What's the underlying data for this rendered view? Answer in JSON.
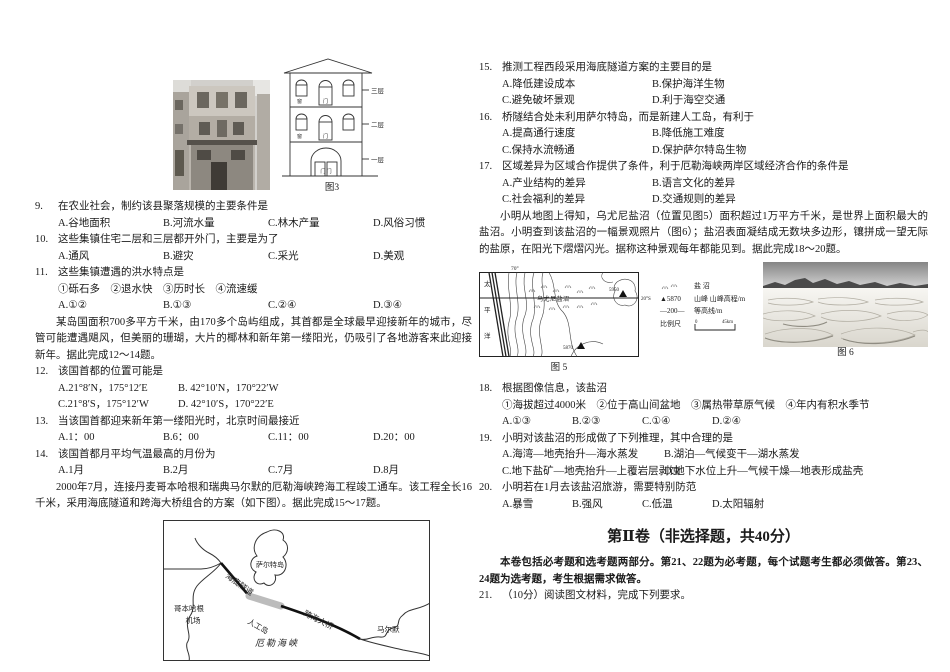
{
  "questions": {
    "q9": {
      "num": "9.",
      "stem": "在农业社会，制约该县聚落规模的主要条件是",
      "layout": "four105",
      "options": [
        "A.谷地面积",
        "B.河流水量",
        "C.林木产量",
        "D.风俗习惯"
      ]
    },
    "q10": {
      "num": "10.",
      "stem": "这些集镇住宅二层和三层都开外门，主要是为了",
      "layout": "four105",
      "options": [
        "A.通风",
        "B.避灾",
        "C.采光",
        "D.美观"
      ]
    },
    "q11": {
      "num": "11.",
      "stem": "这些集镇遭遇的洪水特点是",
      "layout": "four105",
      "sub": "①砾石多　②退水快　③历时长　④流速缓",
      "options": [
        "A.①②",
        "B.①③",
        "C.②④",
        "D.③④"
      ]
    },
    "q12": {
      "num": "12.",
      "stem": "该国首都的位置可能是",
      "layout": "two120",
      "options": [
        "A.21°8′N，175°12′E",
        "B. 42°10′N，170°22′W",
        "C.21°8′S，175°12′W",
        "D. 42°10′S，170°22′E"
      ]
    },
    "q13": {
      "num": "13.",
      "stem": "当该国首都迎来新年第一缕阳光时，北京时间最接近",
      "layout": "four105",
      "options": [
        "A.1：00",
        "B.6：00",
        "C.11：00",
        "D.20：00"
      ]
    },
    "q14": {
      "num": "14.",
      "stem": "该国首都月平均气温最高的月份为",
      "layout": "four105",
      "options": [
        "A.1月",
        "B.2月",
        "C.7月",
        "D.8月"
      ]
    },
    "q15": {
      "num": "15.",
      "stem": "推测工程西段采用海底隧道方案的主要目的是",
      "layout": "two150",
      "options": [
        "A.降低建设成本",
        "B.保护海洋生物",
        "C.避免破坏景观",
        "D.利于海空交通"
      ]
    },
    "q16": {
      "num": "16.",
      "stem": "桥隧结合处未利用萨尔特岛，而是新建人工岛，有利于",
      "layout": "two150",
      "options": [
        "A.提高通行速度",
        "B.降低施工难度",
        "C.保持水流畅通",
        "D.保护萨尔特岛生物"
      ]
    },
    "q17": {
      "num": "17.",
      "stem": "区域差异为区域合作提供了条件，利于厄勒海峡两岸区域经济合作的条件是",
      "layout": "two150",
      "options": [
        "A.产业结构的差异",
        "B.语言文化的差异",
        "C.社会福利的差异",
        "D.交通规则的差异"
      ]
    },
    "q18": {
      "num": "18.",
      "stem": "根据图像信息，该盐沼",
      "layout": "four70",
      "sub": "①海拔超过4000米　②位于高山间盆地　③属热带草原气候　④年内有积水季节",
      "options": [
        "A.①③",
        "B.②③",
        "C.①④",
        "D.②④"
      ]
    },
    "q19": {
      "num": "19.",
      "stem": "小明对该盐沼的形成做了下列推理，其中合理的是",
      "layout": "two162",
      "options": [
        "A.海湾—地壳抬升—海水蒸发",
        "B.湖泊—气候变干—湖水蒸发",
        "C.地下盐矿—地壳抬升—上覆岩层剥蚀",
        "D.地下水位上升—气候干燥—地表形成盐壳"
      ]
    },
    "q20": {
      "num": "20.",
      "stem": "小明若在1月去该盐沼旅游，需要特别防范",
      "layout": "four70",
      "options": [
        "A.暴雪",
        "B.强风",
        "C.低温",
        "D.太阳辐射"
      ]
    },
    "q21": {
      "num": "21.",
      "stem": "（10分）阅读图文材料，完成下列要求。",
      "layout": "none",
      "options": []
    }
  },
  "passages": {
    "island": "某岛国面积700多平方千米，由170多个岛屿组成，其首都是全球最早迎接新年的城市，尽管可能遭遇飓风，但美丽的珊瑚，大片的椰林和新年第一缕阳光，仍吸引了各地游客来此迎接新年。据此完成12～14题。",
    "oresund": "2000年7月，连接丹麦哥本哈根和瑞典马尔默的厄勒海峡跨海工程竣工通车。该工程全长16千米，采用海底隧道和跨海大桥组合的方案（如下图）。据此完成15～17题。",
    "uyuni": "小明从地图上得知，乌尤尼盐沼（位置见图5）面积超过1万平方千米，是世界上面积最大的盐沼。小明查到该盐沼的一幅景观照片（图6）；盐沼表面凝结成无数块多边形，镶拼成一望无际的盐原，在阳光下熠熠闪光。据称这种景观每年都能见到。据此完成18～20题。"
  },
  "section2": {
    "title": "第Ⅱ卷（非选择题，共40分）",
    "note": "本卷包括必考题和选考题两部分。第21、22题为必考题，每个试题考生都必须做答。第23、24题为选考题，考生根据需求做答。"
  },
  "figures": {
    "fig3": {
      "caption": "图3",
      "floor3": "三层",
      "floor2": "二层",
      "floor1": "一层",
      "window": "窗",
      "door": "门",
      "door_double": "门 门"
    },
    "strait": {
      "airport1": "哥本哈根",
      "airport2": "机场",
      "island": "萨尔特岛",
      "tunnel": "海底隧道",
      "artificial": "人工岛",
      "bridge": "跨海大桥",
      "city": "马尔默",
      "strait": "厄勒海峡"
    },
    "fig5": {
      "caption": "图 5",
      "ocean": "太平洋",
      "top_label": "70°",
      "lat_label": "20°S",
      "marsh_label": "乌尤尼盐沼",
      "peak1": "5950",
      "peak2": "5870"
    },
    "legend": {
      "marsh": "盐 沼",
      "peak_sym": "▲5870",
      "peak": "山峰 山峰高程/m",
      "contour_sym": "—200—",
      "contour": "等高线/m",
      "scale": "比例尺",
      "s0": "0",
      "s1": "45km"
    },
    "fig6": {
      "caption": "图 6"
    }
  }
}
